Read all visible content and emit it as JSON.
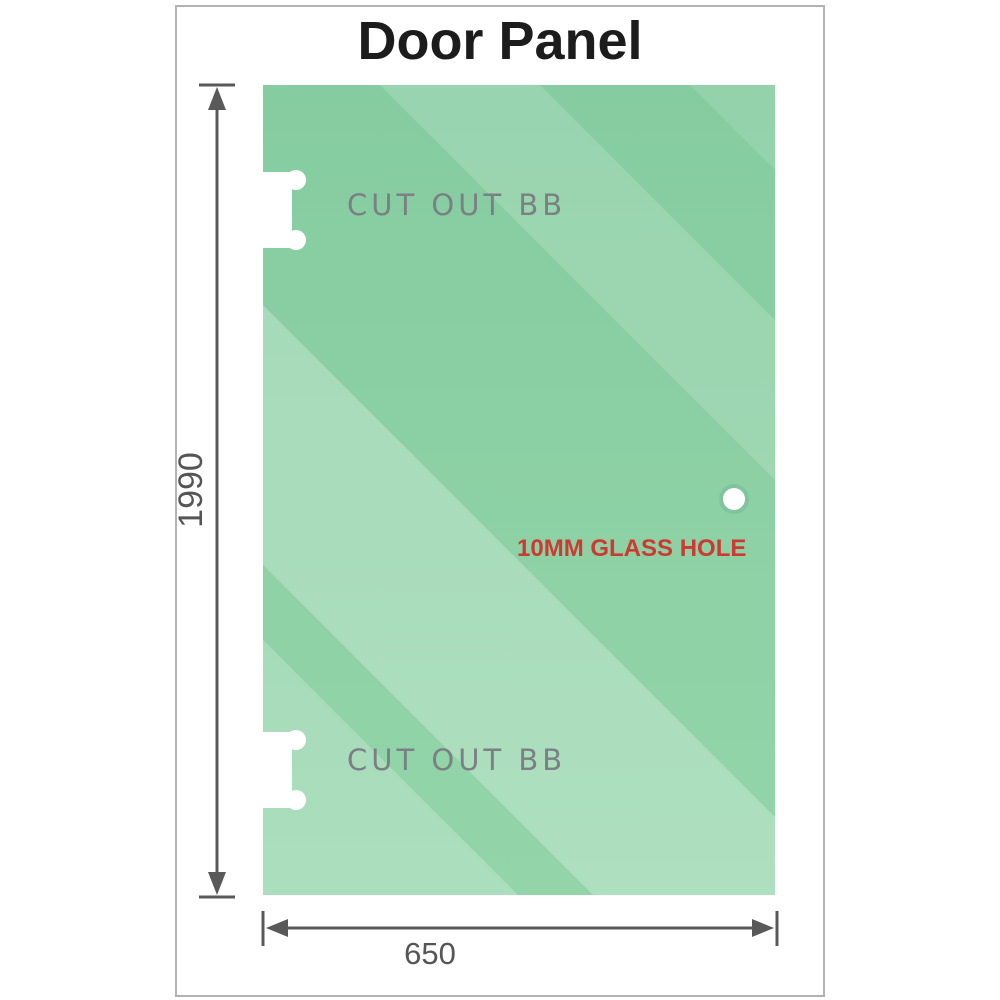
{
  "title": "Door Panel",
  "diagram": {
    "cutout_top_label": "CUT OUT BB",
    "cutout_bottom_label": "CUT OUT BB",
    "hole_label": "10MM GLASS HOLE",
    "height_dimension": "1990",
    "width_dimension": "650"
  },
  "colors": {
    "glass_top": "#85cca0",
    "glass_bottom": "#93d5a9",
    "glass_streak": "#ffffff",
    "hole_ring": "#7fc49c",
    "dimension_gray": "#595959",
    "cutout_label_gray": "#7b8084",
    "annotation_red": "#cc3a31",
    "title_color": "#1c1c1c",
    "frame_border": "#b3b3b3"
  }
}
